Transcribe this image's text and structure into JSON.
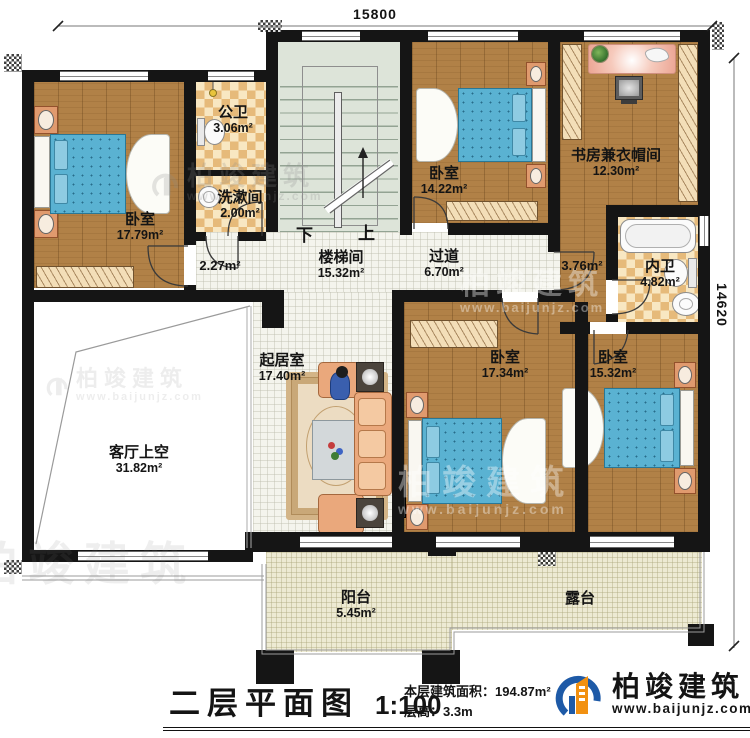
{
  "dimensions": {
    "width_mm": "15800",
    "depth_mm": "14620"
  },
  "stairs": {
    "down_label": "下",
    "up_label": "上"
  },
  "rooms": {
    "bedroom_nw": {
      "name": "卧室",
      "area": "17.79m²"
    },
    "public_bath": {
      "name": "公卫",
      "area": "3.06m²"
    },
    "washroom": {
      "name": "洗漱间",
      "area": "2.00m²"
    },
    "stairwell": {
      "name": "楼梯间",
      "area": "15.32m²"
    },
    "hall_west": {
      "area": "2.27m²"
    },
    "corridor": {
      "name": "过道",
      "area": "6.70m²"
    },
    "bedroom_n": {
      "name": "卧室",
      "area": "14.22m²"
    },
    "study": {
      "name": "书房兼衣帽间",
      "area": "12.30m²"
    },
    "hall_east": {
      "area": "3.76m²"
    },
    "inner_bath": {
      "name": "内卫",
      "area": "4.82m²"
    },
    "living": {
      "name": "起居室",
      "area": "17.40m²"
    },
    "void": {
      "name": "客厅上空",
      "area": "31.82m²"
    },
    "bedroom_s": {
      "name": "卧室",
      "area": "17.34m²"
    },
    "bedroom_se": {
      "name": "卧室",
      "area": "15.32m²"
    },
    "balcony": {
      "name": "阳台",
      "area": "5.45m²"
    },
    "terrace": {
      "name": "露台"
    }
  },
  "footer": {
    "title": "二层平面图",
    "scale": "1:100",
    "floor_area_label": "本层建筑面积：",
    "floor_area_value": "194.87m²",
    "floor_height_label": "层高：",
    "floor_height_value": "3.3m"
  },
  "brand": {
    "name": "柏竣建筑",
    "url": "www.baijunjz.com"
  },
  "watermark": {
    "name": "柏竣建筑",
    "url": "www.baijunjz.com"
  },
  "colors": {
    "wall": "#151515",
    "wood": "#b18147",
    "checker": "#e6ba7a",
    "tile": "#f4f4ed",
    "stair": "#dde4d9",
    "bed_blue": "#5ab2d2",
    "balcony_tile": "#edead3",
    "brand_blue": "#1e5aa7",
    "brand_orange": "#f29111"
  }
}
